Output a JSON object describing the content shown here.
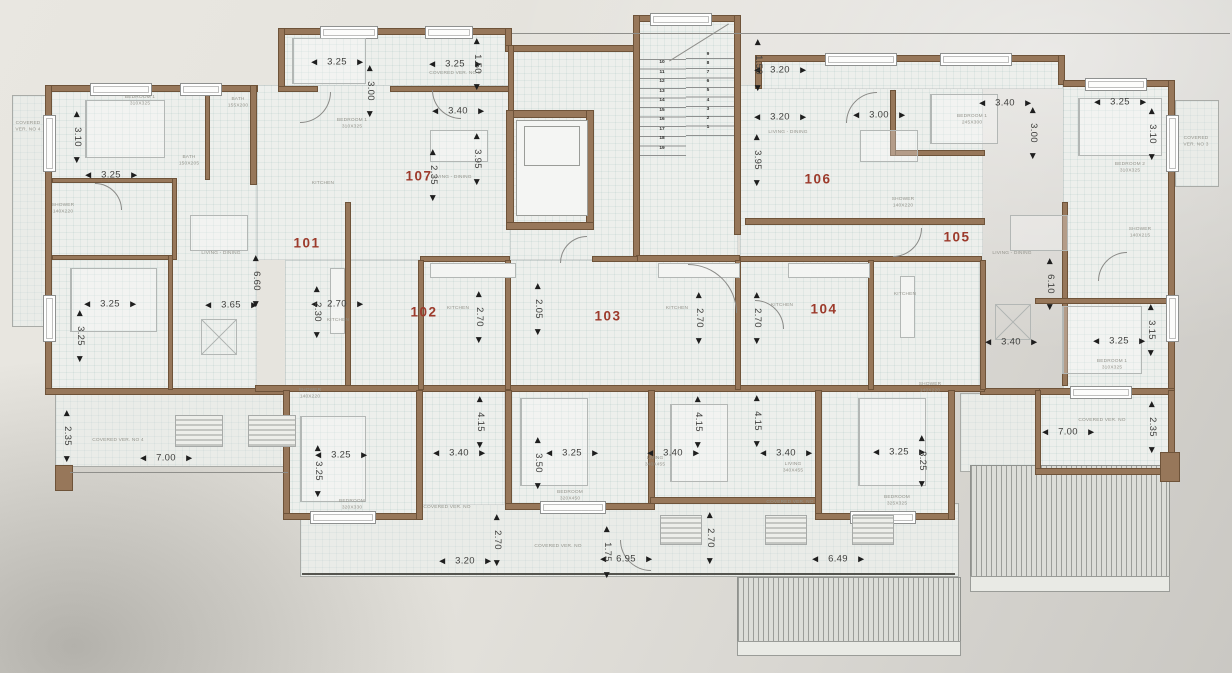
{
  "drawing": {
    "lift_label": "LIFT",
    "mech_label": "MECH",
    "unit_numbers": [
      {
        "t": "101",
        "x": 307,
        "y": 243
      },
      {
        "t": "102",
        "x": 424,
        "y": 312
      },
      {
        "t": "103",
        "x": 608,
        "y": 316
      },
      {
        "t": "104",
        "x": 824,
        "y": 309
      },
      {
        "t": "105",
        "x": 957,
        "y": 237
      },
      {
        "t": "106",
        "x": 818,
        "y": 179
      },
      {
        "t": "107",
        "x": 419,
        "y": 176
      }
    ],
    "dimensions_horizontal": [
      {
        "t": "3.25",
        "x": 337,
        "y": 62
      },
      {
        "t": "3.25",
        "x": 455,
        "y": 64
      },
      {
        "t": "3.40",
        "x": 458,
        "y": 111
      },
      {
        "t": "3.25",
        "x": 111,
        "y": 175
      },
      {
        "t": "3.25",
        "x": 110,
        "y": 304
      },
      {
        "t": "3.65",
        "x": 231,
        "y": 305
      },
      {
        "t": "2.70",
        "x": 337,
        "y": 304
      },
      {
        "t": "7.00",
        "x": 166,
        "y": 458
      },
      {
        "t": "3.25",
        "x": 341,
        "y": 455
      },
      {
        "t": "3.40",
        "x": 459,
        "y": 453
      },
      {
        "t": "3.25",
        "x": 572,
        "y": 453
      },
      {
        "t": "3.40",
        "x": 673,
        "y": 453
      },
      {
        "t": "3.40",
        "x": 786,
        "y": 453
      },
      {
        "t": "3.20",
        "x": 465,
        "y": 561
      },
      {
        "t": "6.95",
        "x": 626,
        "y": 559
      },
      {
        "t": "6.49",
        "x": 838,
        "y": 559
      },
      {
        "t": "3.25",
        "x": 899,
        "y": 452
      },
      {
        "t": "3.20",
        "x": 780,
        "y": 70
      },
      {
        "t": "3.20",
        "x": 780,
        "y": 117
      },
      {
        "t": "3.00",
        "x": 879,
        "y": 115
      },
      {
        "t": "3.40",
        "x": 1005,
        "y": 103
      },
      {
        "t": "3.25",
        "x": 1120,
        "y": 102
      },
      {
        "t": "3.40",
        "x": 1011,
        "y": 342
      },
      {
        "t": "3.25",
        "x": 1119,
        "y": 341
      },
      {
        "t": "7.00",
        "x": 1068,
        "y": 432
      }
    ],
    "dimensions_vertical": [
      {
        "t": "3.10",
        "x": 77,
        "y": 137
      },
      {
        "t": "3.00",
        "x": 370,
        "y": 91
      },
      {
        "t": "1.50",
        "x": 477,
        "y": 64
      },
      {
        "t": "3.95",
        "x": 477,
        "y": 159
      },
      {
        "t": "2.35",
        "x": 433,
        "y": 175
      },
      {
        "t": "3.25",
        "x": 80,
        "y": 336
      },
      {
        "t": "6.60",
        "x": 256,
        "y": 281
      },
      {
        "t": "2.30",
        "x": 317,
        "y": 312
      },
      {
        "t": "2.35",
        "x": 67,
        "y": 436
      },
      {
        "t": "2.70",
        "x": 479,
        "y": 317
      },
      {
        "t": "2.05",
        "x": 538,
        "y": 309
      },
      {
        "t": "2.70",
        "x": 699,
        "y": 318
      },
      {
        "t": "2.70",
        "x": 757,
        "y": 318
      },
      {
        "t": "4.15",
        "x": 480,
        "y": 422
      },
      {
        "t": "4.15",
        "x": 698,
        "y": 422
      },
      {
        "t": "4.15",
        "x": 757,
        "y": 421
      },
      {
        "t": "3.50",
        "x": 538,
        "y": 463
      },
      {
        "t": "2.70",
        "x": 497,
        "y": 540
      },
      {
        "t": "1.75",
        "x": 607,
        "y": 552
      },
      {
        "t": "2.70",
        "x": 710,
        "y": 538
      },
      {
        "t": "3.25",
        "x": 318,
        "y": 471
      },
      {
        "t": "3.25",
        "x": 922,
        "y": 461
      },
      {
        "t": "1.50",
        "x": 758,
        "y": 65
      },
      {
        "t": "3.95",
        "x": 757,
        "y": 160
      },
      {
        "t": "6.10",
        "x": 1050,
        "y": 284
      },
      {
        "t": "3.15",
        "x": 1151,
        "y": 330
      },
      {
        "t": "3.00",
        "x": 1033,
        "y": 133
      },
      {
        "t": "3.10",
        "x": 1152,
        "y": 134
      },
      {
        "t": "2.35",
        "x": 1152,
        "y": 427
      }
    ],
    "room_labels": [
      {
        "t": "BEDROOM 1\n310X325",
        "x": 140,
        "y": 101
      },
      {
        "t": "SHOWER\n140X220",
        "x": 63,
        "y": 209
      },
      {
        "t": "BATH\n155X200",
        "x": 238,
        "y": 103
      },
      {
        "t": "BATH\n150X205",
        "x": 189,
        "y": 161
      },
      {
        "t": "LIVING - DINING",
        "x": 221,
        "y": 254
      },
      {
        "t": "KITCHEN",
        "x": 338,
        "y": 321
      },
      {
        "t": "COVERED\nVER. NO 4",
        "x": 28,
        "y": 127
      },
      {
        "t": "COVERED VER. NO 4",
        "x": 118,
        "y": 441
      },
      {
        "t": "BEDROOM 1\n310X325",
        "x": 352,
        "y": 124
      },
      {
        "t": "KITCHEN",
        "x": 323,
        "y": 184
      },
      {
        "t": "LIVING - DINING",
        "x": 452,
        "y": 178
      },
      {
        "t": "COVERED VER. NO 5",
        "x": 455,
        "y": 74
      },
      {
        "t": "LIVING - DINING",
        "x": 788,
        "y": 133
      },
      {
        "t": "BEDROOM 1\n245X300",
        "x": 972,
        "y": 120
      },
      {
        "t": "SHOWER\n140X220",
        "x": 903,
        "y": 203
      },
      {
        "t": "LIVING - DINING",
        "x": 1012,
        "y": 254
      },
      {
        "t": "KITCHEN",
        "x": 905,
        "y": 295
      },
      {
        "t": "BEDROOM 2\n310X325",
        "x": 1130,
        "y": 168
      },
      {
        "t": "COVERED\nVER. NO 3",
        "x": 1196,
        "y": 142
      },
      {
        "t": "KITCHEN",
        "x": 458,
        "y": 309
      },
      {
        "t": "SHOWER\n140X220",
        "x": 310,
        "y": 394
      },
      {
        "t": "BEDROOM\n320X330",
        "x": 352,
        "y": 505
      },
      {
        "t": "KITCHEN",
        "x": 677,
        "y": 309
      },
      {
        "t": "BEDROOM\n320X450",
        "x": 570,
        "y": 496
      },
      {
        "t": "LIVING\n340X455",
        "x": 655,
        "y": 462
      },
      {
        "t": "KITCHEN",
        "x": 782,
        "y": 306
      },
      {
        "t": "BEDROOM\n325X325",
        "x": 897,
        "y": 501
      },
      {
        "t": "LIVING\n340X455",
        "x": 793,
        "y": 468
      },
      {
        "t": "BEDROOM 1\n310X325",
        "x": 1112,
        "y": 365
      },
      {
        "t": "COVERED VER. NO",
        "x": 1102,
        "y": 421
      },
      {
        "t": "COVERED VER. NO",
        "x": 558,
        "y": 547
      },
      {
        "t": "COVERED VER. NO",
        "x": 447,
        "y": 508
      },
      {
        "t": "COVERED VER. NO",
        "x": 790,
        "y": 503
      },
      {
        "t": "SHOWER\n140X220",
        "x": 930,
        "y": 388
      },
      {
        "t": "SHOWER\n140X215",
        "x": 1140,
        "y": 233
      }
    ],
    "stairs": {
      "left_steps": [
        "10",
        "11",
        "12",
        "13",
        "14",
        "15",
        "16",
        "17",
        "18",
        "19"
      ],
      "right_steps": [
        "9",
        "8",
        "7",
        "6",
        "5",
        "4",
        "3",
        "2",
        "1"
      ]
    },
    "colors": {
      "wall": "#97775a",
      "wall_outline": "#6e5339",
      "unit_number": "#9c3a2b",
      "dimension_text": "#3f3f3d",
      "room_text": "#94948c",
      "deck_line": "#9b9d99"
    }
  }
}
